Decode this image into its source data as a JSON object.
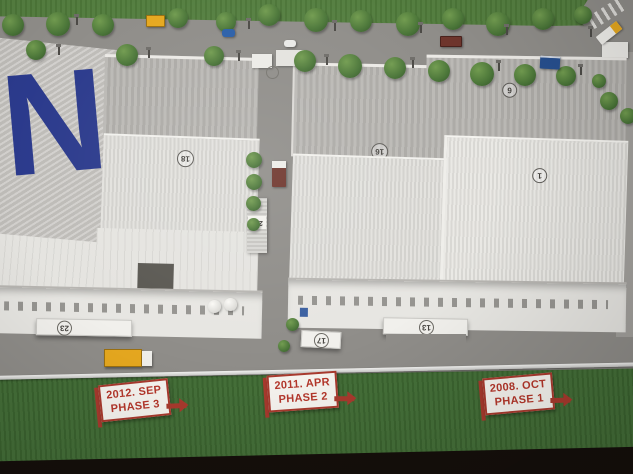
{
  "logo": {
    "letter": "N"
  },
  "signs": [
    {
      "date": "2012. SEP",
      "phase": "PHASE 3"
    },
    {
      "date": "2011. APR",
      "phase": "PHASE 2"
    },
    {
      "date": "2008. OCT",
      "phase": "PHASE 1"
    }
  ],
  "markers": {
    "left_roof": "18",
    "center_roof": "16",
    "right_roof_upper": "6",
    "right_roof_lower": "1",
    "canopy_left": "23",
    "canopy_center": "17",
    "canopy_right": "13",
    "utility_tower": "206"
  },
  "colors": {
    "grass_top": "#507b3b",
    "grass_bottom": "#3f6b33",
    "road": "#8f8d89",
    "roof_gray": "#b3b1ad",
    "roof_white": "#e0dfdb",
    "sign_red": "#a93a2e",
    "sign_text_red": "#b5372b",
    "logo_blue": "#2b3a8c",
    "truck_yellow": "#e6a81f",
    "truck_darkred": "#6e352c",
    "car_blue": "#2a5fa8",
    "table_dark": "#150f0b"
  }
}
